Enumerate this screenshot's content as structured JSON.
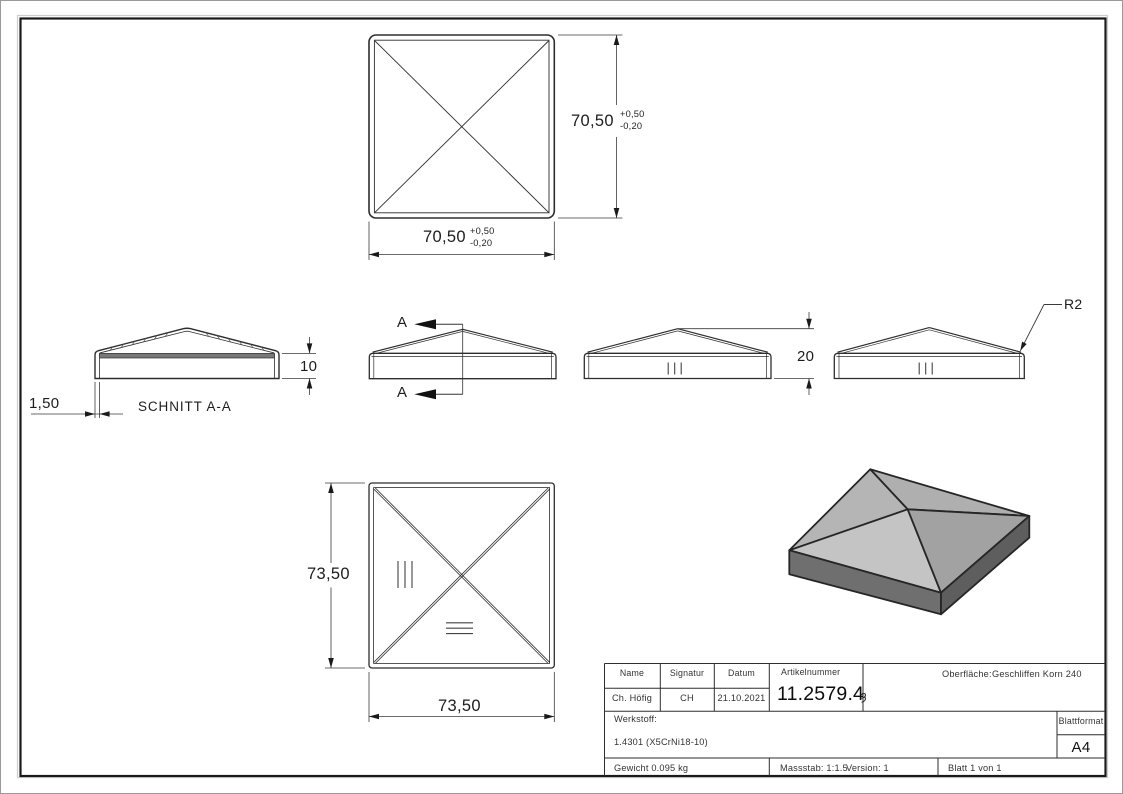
{
  "sheet": {
    "views": {
      "top": {
        "width": "70,50",
        "height": "70,50",
        "tol_plus": "+0,50",
        "tol_minus": "-0,20"
      },
      "section": {
        "title": "SCHNITT A-A",
        "wall_thickness": "1,50",
        "skirt_height": "10"
      },
      "front": {
        "cut_label": "A"
      },
      "height_view": {
        "total_height": "20"
      },
      "radius_view": {
        "corner_radius": "R2"
      },
      "bottom": {
        "width": "73,50",
        "height": "73,50"
      }
    },
    "title_block": {
      "name_header": "Name",
      "signature_header": "Signatur",
      "date_header": "Datum",
      "article_header": "Artikelnummer",
      "surface_label": "Oberfläche:",
      "surface_value": "Geschliffen Korn 240",
      "name_value": "Ch. Höfig",
      "signature_value": "CH",
      "date_value": "21.10.2021",
      "article_value": "11.2579.4",
      "article_suffix": "ȝ",
      "material_label": "Werkstoff:",
      "material_value": "1.4301 (X5CrNi18-10)",
      "weight": "Gewicht 0.095 kg",
      "scale": "Massstab: 1:1.5",
      "version": "Version: 1",
      "sheet_count": "Blatt 1 von 1",
      "format_label": "Blattformat",
      "format_value": "A4"
    },
    "colors": {
      "line": "#2e2e2e",
      "dim_line": "#3a3a3a",
      "section_cut_fill": "#787878",
      "iso_face_light": "#c4c4c4",
      "iso_face_mid": "#b2b2b2",
      "iso_face_dark": "#a2a2a2",
      "iso_skirt": "#6f6f6f",
      "iso_skirt_dark": "#5e5e5e"
    }
  }
}
